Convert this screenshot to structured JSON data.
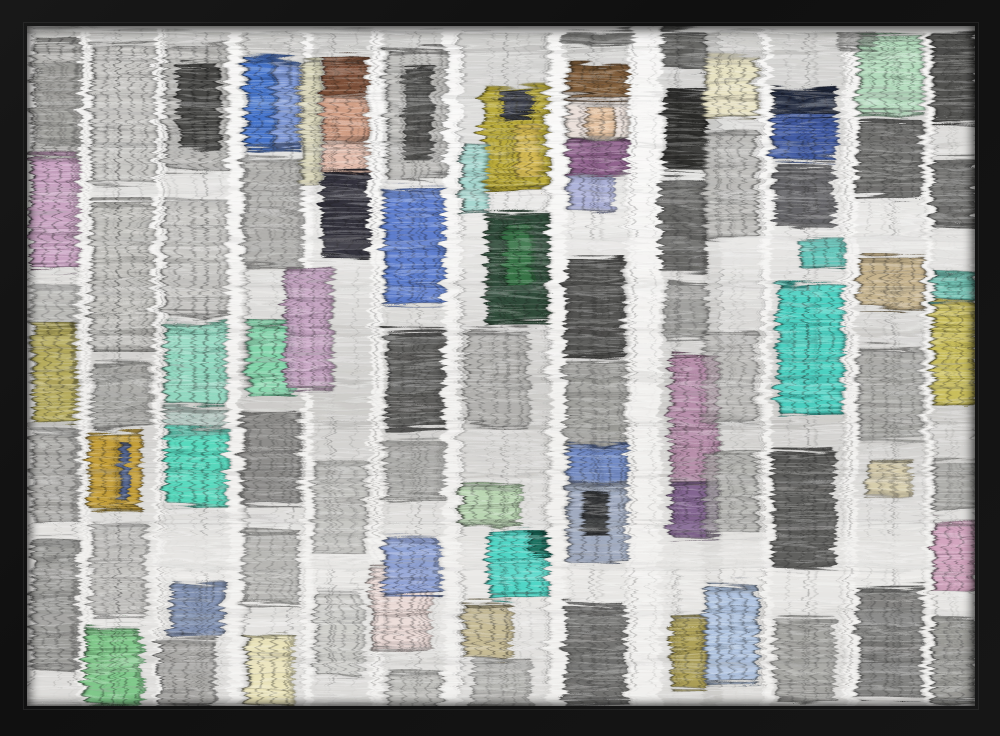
{
  "scene": "black-framed art print of a building facade with colored windows reflected in rippling water",
  "frame": {
    "color": "#101010",
    "lip_color": "#464646"
  },
  "artwork": {
    "background": "#efeeec",
    "highlight": "#ffffff",
    "ripple": {
      "base_frequency": "0.01 0.18",
      "octaves": 2,
      "seed": 8,
      "scale": 17
    },
    "palette": {
      "bright_blue": "#3f6fca",
      "navy": "#1a2238",
      "periwinkle": "#8a9ed4",
      "pale_blue": "#adc2e0",
      "teal": "#45cfc0",
      "mint": "#8fd8c0",
      "pale_green": "#b2dbbc",
      "green": "#7cc787",
      "dark_green": "#1f3d2a",
      "yellow": "#b8a832",
      "gold": "#c29a2e",
      "cream": "#e9e2b8",
      "tan": "#c4b088",
      "copper": "#7a4a32",
      "peach": "#cf9a80",
      "pink": "#c79fc0",
      "mauve": "#b58aa8",
      "plum": "#8a5a88",
      "gray": "#9a9a96",
      "dark": "#3c3c3a"
    },
    "columns": [
      [
        2,
        48
      ],
      [
        58,
        66
      ],
      [
        132,
        66
      ],
      [
        210,
        62
      ],
      [
        280,
        60
      ],
      [
        352,
        62
      ],
      [
        430,
        90
      ],
      [
        534,
        64
      ],
      [
        630,
        58
      ],
      [
        670,
        60
      ],
      [
        740,
        74
      ],
      [
        825,
        70
      ],
      [
        900,
        47
      ]
    ],
    "windows": [
      [
        2,
        12,
        48,
        118,
        "#b0afac",
        0.9
      ],
      [
        6,
        30,
        40,
        85,
        "#8a8a86",
        0.5
      ],
      [
        0,
        125,
        48,
        115,
        "#c79fc0",
        0.95
      ],
      [
        2,
        255,
        46,
        40,
        "#a8a8a4",
        0.6
      ],
      [
        2,
        293,
        44,
        100,
        "#b3a855",
        0.92
      ],
      [
        2,
        400,
        46,
        95,
        "#a3a29f",
        0.8
      ],
      [
        2,
        510,
        46,
        130,
        "#8d8d8a",
        0.8
      ],
      [
        60,
        14,
        64,
        140,
        "#c6c5c2",
        0.9
      ],
      [
        60,
        170,
        62,
        150,
        "#bdbcb8",
        0.85
      ],
      [
        62,
        332,
        58,
        66,
        "#9a9a96",
        0.7
      ],
      [
        57,
        402,
        53,
        76,
        "#c29a2e",
        0.92
      ],
      [
        88,
        412,
        10,
        58,
        "#3a5aa8",
        0.8
      ],
      [
        60,
        492,
        56,
        95,
        "#b0afac",
        0.7
      ],
      [
        54,
        596,
        58,
        80,
        "#7cc787",
        0.95
      ],
      [
        134,
        14,
        62,
        126,
        "#b4b3b0",
        0.85
      ],
      [
        147,
        34,
        42,
        84,
        "#2e2e2c",
        0.8
      ],
      [
        134,
        168,
        62,
        118,
        "#c2c1be",
        0.8
      ],
      [
        134,
        292,
        62,
        82,
        "#8fd8c0",
        0.95
      ],
      [
        134,
        378,
        62,
        22,
        "#a8c4bc",
        0.7
      ],
      [
        134,
        398,
        62,
        78,
        "#52d8bc",
        0.95
      ],
      [
        140,
        552,
        53,
        53,
        "#7a8cb0",
        0.9
      ],
      [
        128,
        608,
        56,
        70,
        "#9d9c99",
        0.8
      ],
      [
        214,
        29,
        53,
        90,
        "#3f6fca",
        0.95
      ],
      [
        243,
        31,
        24,
        86,
        "#8aa0d8",
        0.85
      ],
      [
        212,
        128,
        58,
        108,
        "#9b9a97",
        0.7
      ],
      [
        217,
        293,
        46,
        73,
        "#7ed4a8",
        0.95
      ],
      [
        212,
        380,
        56,
        95,
        "#777674",
        0.75
      ],
      [
        212,
        500,
        54,
        75,
        "#9a9a96",
        0.6
      ],
      [
        215,
        602,
        47,
        77,
        "#e9e2b8",
        0.97
      ],
      [
        268,
        28,
        22,
        128,
        "#d6d2b4",
        0.9
      ],
      [
        291,
        28,
        46,
        38,
        "#7a4a32",
        0.95
      ],
      [
        291,
        64,
        46,
        48,
        "#cf9a80",
        0.95
      ],
      [
        291,
        110,
        46,
        32,
        "#e3bcab",
        0.95
      ],
      [
        291,
        140,
        48,
        88,
        "#23222e",
        0.9
      ],
      [
        253,
        236,
        48,
        122,
        "#c3a0c0",
        0.93
      ],
      [
        282,
        430,
        54,
        95,
        "#aeaeaa",
        0.6
      ],
      [
        284,
        560,
        48,
        85,
        "#c6c6c2",
        0.7
      ],
      [
        355,
        18,
        60,
        130,
        "#b9b8b5",
        0.85
      ],
      [
        372,
        38,
        30,
        92,
        "#3b3b39",
        0.8
      ],
      [
        353,
        157,
        60,
        117,
        "#5577cc",
        0.93
      ],
      [
        355,
        300,
        58,
        100,
        "#4c4c4a",
        0.85
      ],
      [
        355,
        408,
        58,
        62,
        "#8f8f8c",
        0.6
      ],
      [
        340,
        534,
        60,
        85,
        "#ead9d5",
        0.95
      ],
      [
        353,
        504,
        57,
        62,
        "#8a9ed4",
        0.92
      ],
      [
        357,
        640,
        54,
        39,
        "#b5b5b1",
        0.7
      ],
      [
        452,
        56,
        65,
        104,
        "#b8a832",
        0.95
      ],
      [
        470,
        60,
        32,
        28,
        "#2a3050",
        0.85
      ],
      [
        484,
        96,
        26,
        52,
        "#d8bc5a",
        0.8
      ],
      [
        430,
        113,
        26,
        70,
        "#9fd4cc",
        0.9
      ],
      [
        455,
        182,
        62,
        112,
        "#1f3d2a",
        0.9
      ],
      [
        472,
        196,
        30,
        60,
        "#3a7a4a",
        0.85
      ],
      [
        436,
        300,
        62,
        96,
        "#a8a7a4",
        0.75
      ],
      [
        430,
        452,
        60,
        43,
        "#b8d4b0",
        0.95
      ],
      [
        457,
        499,
        60,
        70,
        "#4ad4c4",
        0.95
      ],
      [
        500,
        500,
        18,
        26,
        "#1a6a5a",
        0.9
      ],
      [
        433,
        572,
        47,
        57,
        "#c4b890",
        0.92
      ],
      [
        442,
        630,
        58,
        49,
        "#9c9c98",
        0.6
      ],
      [
        537,
        34,
        60,
        35,
        "#7a5530",
        0.92
      ],
      [
        537,
        69,
        60,
        40,
        "#eadfd8",
        0.95
      ],
      [
        555,
        74,
        28,
        32,
        "#e8c4a0",
        0.9
      ],
      [
        537,
        109,
        60,
        37,
        "#8a5a88",
        0.92
      ],
      [
        537,
        144,
        46,
        36,
        "#a8aed8",
        0.9
      ],
      [
        535,
        226,
        58,
        100,
        "#3c3c3a",
        0.85
      ],
      [
        535,
        330,
        60,
        90,
        "#8d8d89",
        0.7
      ],
      [
        537,
        413,
        60,
        39,
        "#6a85c4",
        0.92
      ],
      [
        537,
        452,
        60,
        80,
        "#98a4bc",
        0.88
      ],
      [
        552,
        460,
        24,
        44,
        "#2b2b29",
        0.85
      ],
      [
        535,
        574,
        60,
        100,
        "#595957",
        0.8
      ],
      [
        632,
        0,
        42,
        40,
        "#3c3c3a",
        0.7
      ],
      [
        634,
        57,
        42,
        82,
        "#1e1e1c",
        0.9
      ],
      [
        630,
        150,
        44,
        92,
        "#4b4b49",
        0.8
      ],
      [
        634,
        252,
        42,
        58,
        "#7b7b78",
        0.6
      ],
      [
        640,
        323,
        47,
        129,
        "#b58aa8",
        0.93
      ],
      [
        640,
        452,
        47,
        55,
        "#7a5a8a",
        0.9
      ],
      [
        640,
        585,
        33,
        74,
        "#a89a4a",
        0.9
      ],
      [
        672,
        24,
        55,
        63,
        "#e8e2c2",
        0.95
      ],
      [
        672,
        100,
        55,
        108,
        "#b4b3b0",
        0.8
      ],
      [
        672,
        300,
        54,
        92,
        "#b0afac",
        0.6
      ],
      [
        672,
        420,
        55,
        85,
        "#a2a29e",
        0.7
      ],
      [
        673,
        555,
        54,
        97,
        "#adc2e0",
        0.93
      ],
      [
        742,
        57,
        64,
        27,
        "#1a2238",
        0.95
      ],
      [
        742,
        84,
        64,
        47,
        "#3a55a0",
        0.95
      ],
      [
        744,
        135,
        60,
        60,
        "#46464a",
        0.8
      ],
      [
        767,
        207,
        45,
        30,
        "#5ac4b8",
        0.9
      ],
      [
        747,
        253,
        65,
        130,
        "#45cfc0",
        0.95
      ],
      [
        742,
        420,
        62,
        118,
        "#4b4b49",
        0.85
      ],
      [
        744,
        588,
        60,
        82,
        "#8b8b87",
        0.7
      ],
      [
        827,
        4,
        65,
        80,
        "#b2dbbc",
        0.95
      ],
      [
        827,
        90,
        64,
        78,
        "#5c5c5a",
        0.85
      ],
      [
        827,
        226,
        66,
        53,
        "#c4b088",
        0.92
      ],
      [
        827,
        318,
        64,
        92,
        "#9b9b97",
        0.7
      ],
      [
        836,
        428,
        44,
        38,
        "#d4c8a0",
        0.8
      ],
      [
        827,
        556,
        64,
        112,
        "#6c6c6a",
        0.8
      ],
      [
        902,
        0,
        45,
        95,
        "#3c3c3a",
        0.85
      ],
      [
        902,
        128,
        45,
        72,
        "#5b5b59",
        0.8
      ],
      [
        902,
        244,
        45,
        28,
        "#6ac4b4",
        0.9
      ],
      [
        902,
        272,
        45,
        102,
        "#c9bd55",
        0.93
      ],
      [
        902,
        430,
        45,
        50,
        "#8e8e8a",
        0.6
      ],
      [
        902,
        492,
        45,
        70,
        "#d0a0bc",
        0.93
      ],
      [
        902,
        588,
        45,
        85,
        "#8a8a86",
        0.8
      ],
      [
        532,
        0,
        70,
        14,
        "#3c3c3a",
        0.6
      ],
      [
        806,
        0,
        40,
        20,
        "#555553",
        0.5
      ]
    ]
  }
}
